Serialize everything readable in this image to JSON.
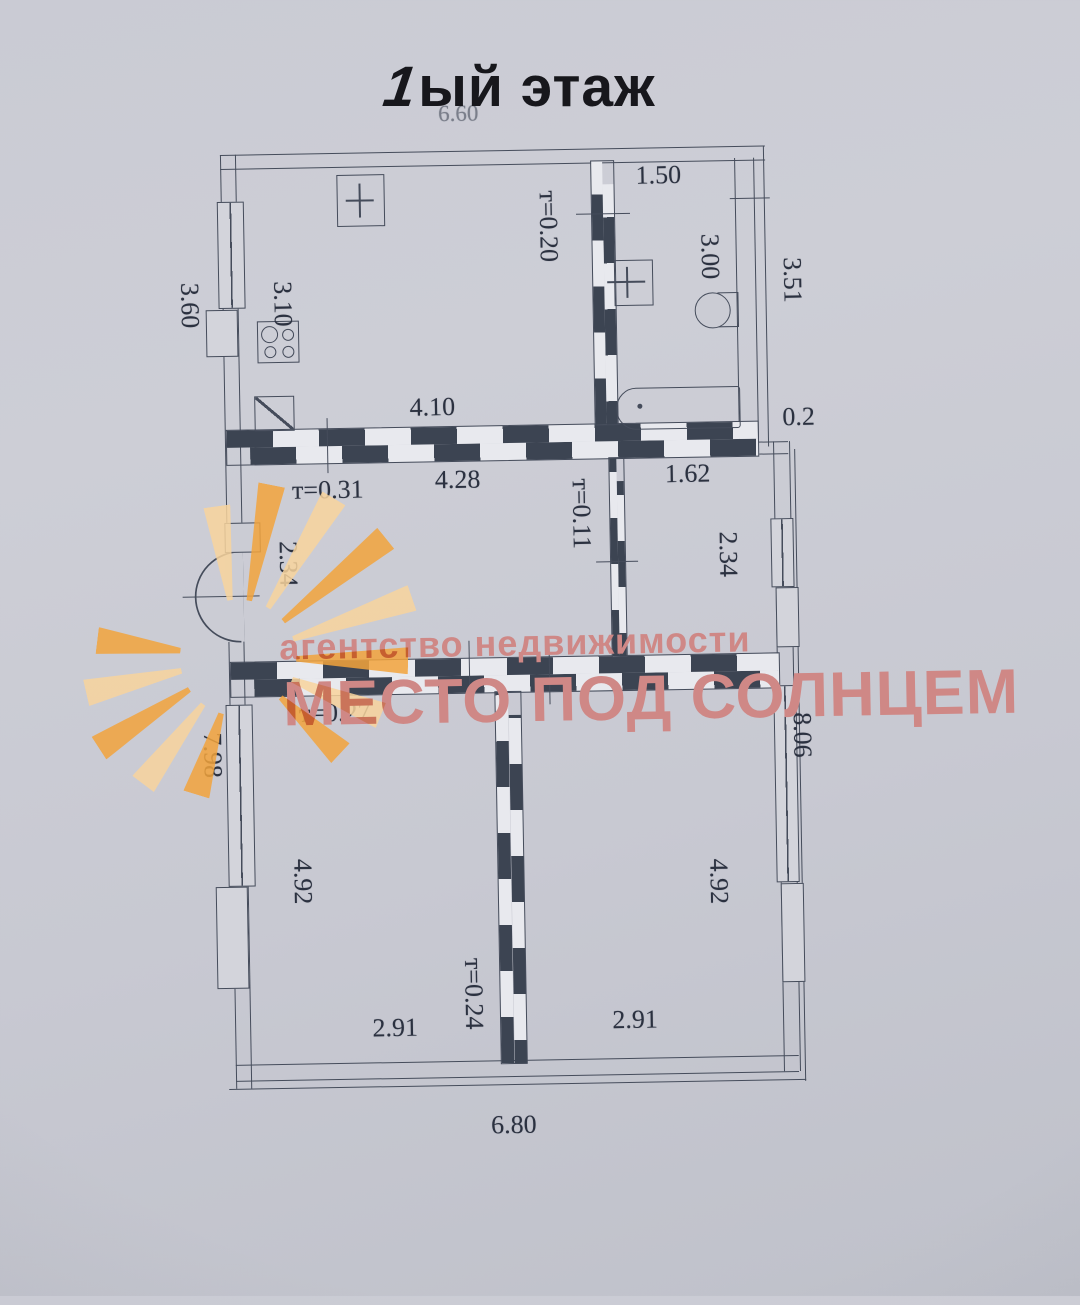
{
  "title": {
    "num": "1",
    "rest": "ый этаж"
  },
  "watermark": {
    "line1": "агентство недвижимости",
    "line2": "МЕСТО ПОД СОЛНЦЕМ"
  },
  "labels": {
    "dim_660": "6.60",
    "dim_150": "1.50",
    "dim_300": "3.00",
    "dim_351": "3.51",
    "dim_360": "3.60",
    "dim_310": "3.10",
    "t020": "т=0.20",
    "dim_410": "4.10",
    "dim_02": "0.2",
    "t031": "т=0.31",
    "dim_428": "4.28",
    "dim_162": "1.62",
    "t011": "т=0.11",
    "dim_234_left": "2.34",
    "dim_234_right": "2.34",
    "t027": "т=0.27",
    "dim_798": "7.98",
    "dim_806": "8.06",
    "dim_492_left": "4.92",
    "dim_492_right": "4.92",
    "t024": "т=0.24",
    "dim_291_left": "2.91",
    "dim_291_right": "2.91",
    "dim_680": "6.80"
  },
  "colors": {
    "paper": "#cbccd4",
    "ink": "#454c5b",
    "wall-dark": "#3c4452",
    "label-ink": "#2b3140",
    "title-ink": "#17171c",
    "dim-faint": "#7a7e8a",
    "sun-a": "#f2a33b",
    "sun-b": "#f8d49c",
    "wm-text": "#cf8886"
  }
}
